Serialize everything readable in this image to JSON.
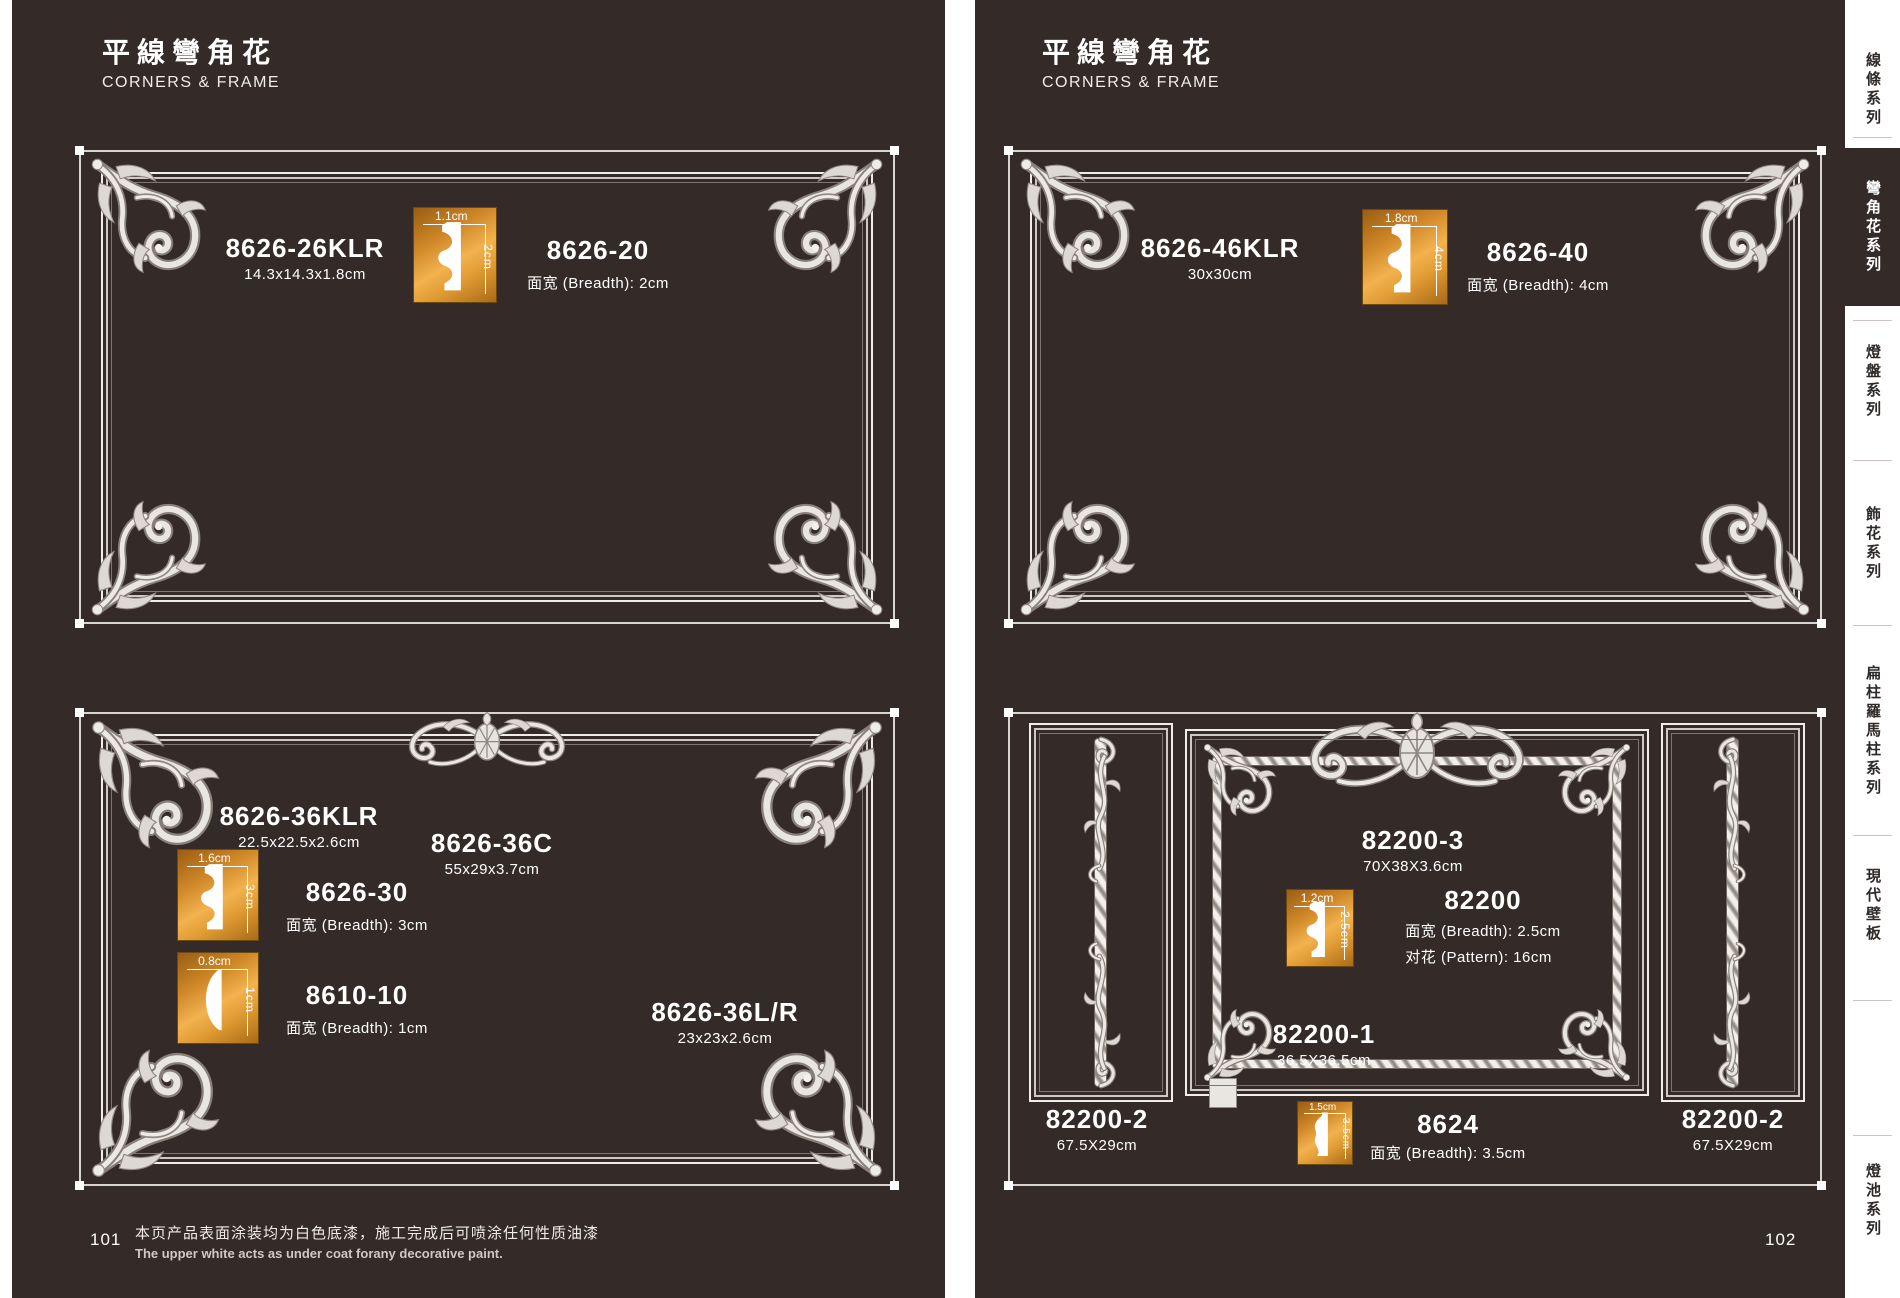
{
  "sidebar": {
    "items": [
      {
        "label": "線條系列",
        "active": false
      },
      {
        "label": "彎角花系列",
        "active": true
      },
      {
        "label": "燈盤系列",
        "active": false
      },
      {
        "label": "飾花系列",
        "active": false
      },
      {
        "label": "扁柱羅馬柱系列",
        "active": false
      },
      {
        "label": "現代壁板",
        "active": false
      },
      {
        "label": "燈池系列",
        "active": false
      }
    ]
  },
  "left": {
    "title_cn": "平線彎角花",
    "title_en": "CORNERS & FRAME",
    "page_number": "101",
    "footnote_cn": "本页产品表面涂装均为白色底漆，施工完成后可喷涂任何性质油漆",
    "footnote_en": "The upper white acts as under coat forany decorative paint.",
    "top": {
      "corner": {
        "code": "8626-26KLR",
        "size": "14.3x14.3x1.8cm"
      },
      "profile": {
        "width": "1.1cm",
        "height": "2cm"
      },
      "molding": {
        "code": "8626-20",
        "spec": "面宽 (Breadth): 2cm"
      }
    },
    "bottom": {
      "corner": {
        "code": "8626-36KLR",
        "size": "22.5x22.5x2.6cm"
      },
      "crest": {
        "code": "8626-36C",
        "size": "55x29x3.7cm"
      },
      "molding1": {
        "code": "8626-30",
        "spec": "面宽 (Breadth): 3cm",
        "profile_w": "1.6cm",
        "profile_h": "3cm"
      },
      "molding2": {
        "code": "8610-10",
        "spec": "面宽 (Breadth): 1cm",
        "profile_w": "0.8cm",
        "profile_h": "1cm"
      },
      "corner_lr": {
        "code": "8626-36L/R",
        "size": "23x23x2.6cm"
      }
    }
  },
  "right": {
    "title_cn": "平線彎角花",
    "title_en": "CORNERS & FRAME",
    "page_number": "102",
    "top": {
      "corner": {
        "code": "8626-46KLR",
        "size": "30x30cm"
      },
      "profile": {
        "width": "1.8cm",
        "height": "4cm"
      },
      "molding": {
        "code": "8626-40",
        "spec": "面宽 (Breadth): 4cm"
      }
    },
    "bottom": {
      "crest": {
        "code": "82200-3",
        "size": "70X38X3.6cm"
      },
      "molding": {
        "code": "82200",
        "spec1": "面宽 (Breadth): 2.5cm",
        "spec2": "对花 (Pattern): 16cm",
        "profile_w": "1.2cm",
        "profile_h": "2.5cm"
      },
      "frame": {
        "code": "82200-1",
        "size": "36.5X36.5cm"
      },
      "strip": {
        "code": "8624",
        "spec": "面宽 (Breadth): 3.5cm",
        "profile_w": "1.5cm",
        "profile_h": "3.5cm"
      },
      "side_left": {
        "code": "82200-2",
        "size": "67.5X29cm"
      },
      "side_right": {
        "code": "82200-2",
        "size": "67.5X29cm"
      }
    }
  }
}
